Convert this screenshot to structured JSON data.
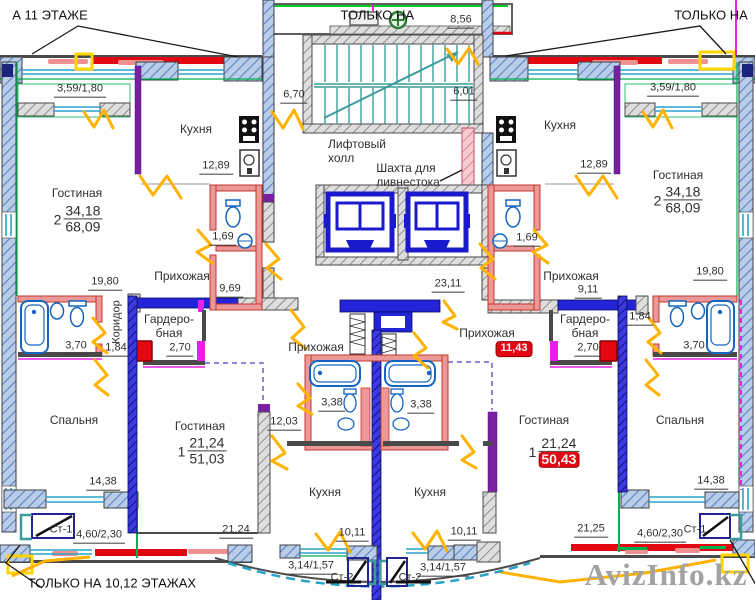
{
  "notes": {
    "top_left": "А 11 ЭТАЖЕ",
    "top_right_a": "ТОЛЬКО НА",
    "top_right_b": "ТОЛЬКО НА",
    "bottom": "ТОЛЬКО НА 10,12 ЭТАЖАХ",
    "watermark": "AvizInfo.kz"
  },
  "core": {
    "elevator_hall_line1": "Лифтовый",
    "elevator_hall_line2": "холл",
    "shaft_line1": "Шахта для",
    "shaft_line2": "ливнестока",
    "left_lobby_area": "6,70",
    "right_lobby_area": "6,01",
    "top_balcony_area": "8,56",
    "corridor_area": "23,11"
  },
  "apt_top_left": {
    "living": {
      "label": "Гостиная",
      "rooms": "2",
      "living_area": "34,18",
      "total_area": "68,09"
    },
    "living_room_area": "19,80",
    "kitchen_label": "Кухня",
    "kitchen_area": "12,89",
    "wc_area": "1,69",
    "hall_label": "Прихожая",
    "hall_area": "9,69",
    "wardrobe_line1": "Гардеро-",
    "wardrobe_line2": "бная",
    "wardrobe_area": "2,70",
    "corridor_label": "Коридор",
    "corridor_area": "1,84",
    "bath_area": "3,70",
    "bedroom_label": "Спальня",
    "bedroom_area": "14,38",
    "balcony_area": "3,59/1,80",
    "loggia_area": "4,60/2,30",
    "riser": "Ст-1"
  },
  "apt_top_right": {
    "living": {
      "label": "Гостиная",
      "rooms": "2",
      "living_area": "34,18",
      "total_area": "68,09"
    },
    "living_room_area": "19,80",
    "kitchen_label": "Кухня",
    "kitchen_area": "12,89",
    "wc_area": "1,69",
    "hall_label": "Прихожая",
    "hall_area": "9,11",
    "wardrobe_line1": "Гардеро-",
    "wardrobe_line2": "бная",
    "wardrobe_area": "2,70",
    "corridor_area": "1,84",
    "bath_area": "3,70",
    "bedroom_label": "Спальня",
    "bedroom_area": "14,38",
    "balcony_area": "3,59/1,80",
    "loggia_area": "4,60/2,30",
    "riser": "Ст-1"
  },
  "apt_bottom_left": {
    "living": {
      "label": "Гостиная",
      "rooms": "1",
      "living_area": "21,24",
      "total_area": "51,03"
    },
    "hall_label": "Прихожая",
    "hall_area": "12,03",
    "bath_area": "3,38",
    "kitchen_label": "Кухня",
    "kitchen_area": "10,11",
    "living_width": "21,24",
    "balcony_area": "3,14/1,57",
    "riser": "Ст-2"
  },
  "apt_bottom_right": {
    "living": {
      "label": "Гостиная",
      "rooms": "1",
      "living_area": "21,24",
      "total_area": "50,43"
    },
    "hall_label": "Прихожая",
    "hall_area": "11,43",
    "bath_area": "3,38",
    "kitchen_label": "Кухня",
    "kitchen_area": "10,11",
    "living_width": "21,25",
    "balcony_area": "3,14/1,57",
    "riser": "Ст-2"
  },
  "colors": {
    "highlight_red": "#e30613",
    "walls_dark": "#4a4a4a",
    "door_yellow": "#ffb300",
    "plumbing_blue": "#2323d8",
    "accent_green": "#00b050",
    "window_cyan": "#29a3c8",
    "partition_pink": "#ec9898"
  }
}
